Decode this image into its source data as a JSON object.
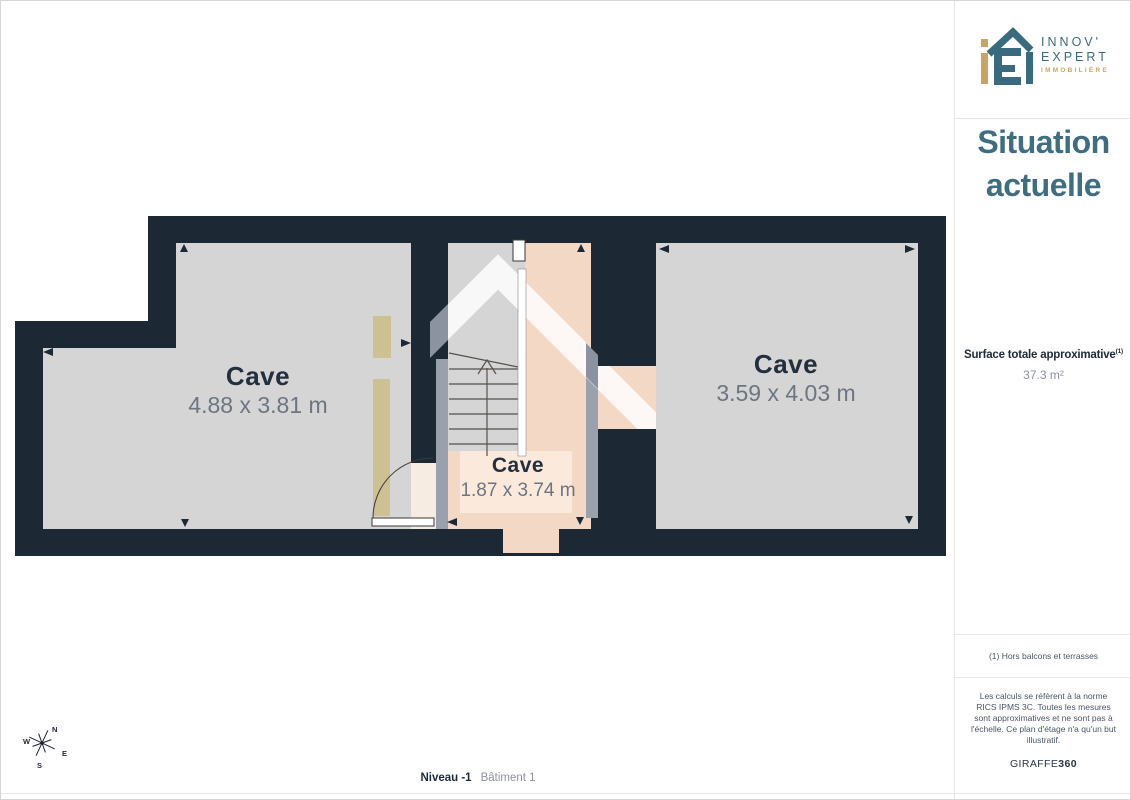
{
  "sidebar": {
    "logo": {
      "line1": "INNOV'",
      "line2": "EXPERT",
      "line3": "IMMOBILIÈRE"
    },
    "title_line1": "Situation",
    "title_line2": "actuelle",
    "surface_label": "Surface totale approximative",
    "surface_sup": "(1)",
    "surface_value": "37.3 m²",
    "footnote": "(1) Hors balcons et terrasses",
    "disclaimer": "Les calculs se réfèrent à la norme RICS IPMS 3C. Toutes les mesures sont approximatives et ne sont pas à l'échelle. Ce plan d'étage n'a qu'un but illustratif.",
    "brand_name": "GIRAFFE",
    "brand_suffix": "360"
  },
  "plan": {
    "rooms": [
      {
        "name": "Cave",
        "dims": "4.88 x 3.81 m"
      },
      {
        "name": "Cave",
        "dims": "1.87 x 3.74 m"
      },
      {
        "name": "Cave",
        "dims": "3.59 x 4.03 m"
      }
    ]
  },
  "footer": {
    "level": "Niveau -1",
    "building": "Bâtiment 1"
  },
  "compass": {
    "n": "N",
    "e": "E",
    "s": "S",
    "w": "W"
  },
  "colors": {
    "wall": "#1c2935",
    "floor": "#d5d5d6",
    "highlight": "#f3d8c6",
    "highlight_light": "#fbe9dc",
    "door_beige": "#cdc193",
    "wall_shadow": "#9aa1ad",
    "accent_teal": "#3f6e81",
    "accent_gold": "#c9a660"
  }
}
